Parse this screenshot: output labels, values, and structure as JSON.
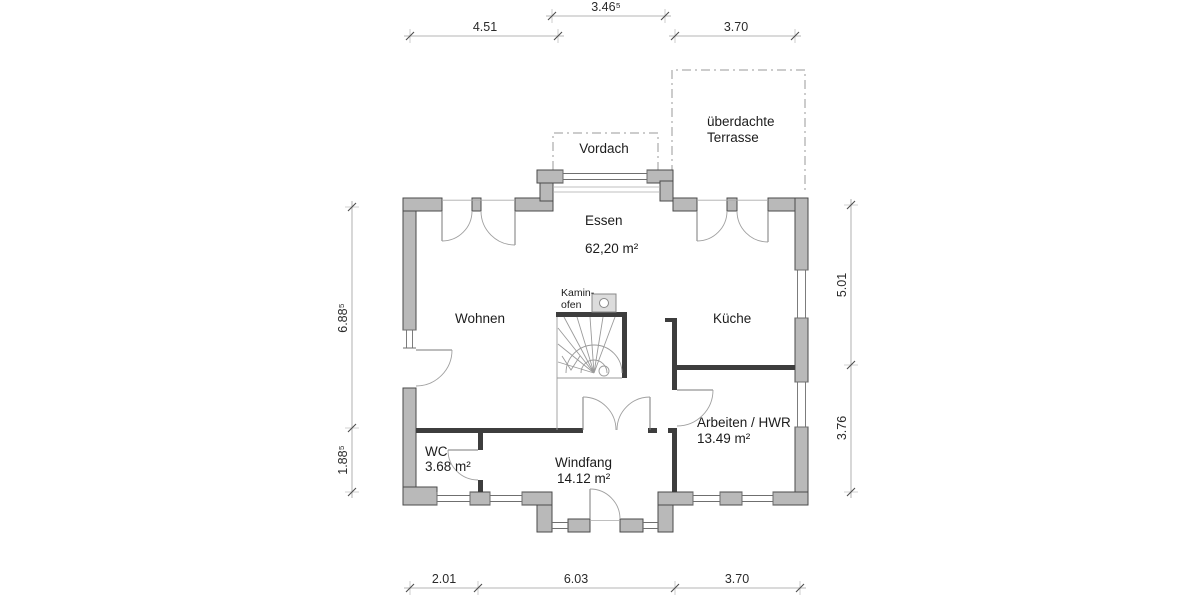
{
  "rooms": {
    "essen": {
      "name": "Essen",
      "area": "62,20 m²"
    },
    "wohnen": {
      "name": "Wohnen"
    },
    "kueche": {
      "name": "Küche"
    },
    "arbeiten": {
      "name": "Arbeiten / HWR",
      "area": "13.49 m²"
    },
    "wc": {
      "name": "WC",
      "area": "3.68 m²"
    },
    "windfang": {
      "name": "Windfang",
      "area": "14.12 m²"
    }
  },
  "annotations": {
    "vordach": "Vordach",
    "terrasse_line1": "überdachte",
    "terrasse_line2": "Terrasse",
    "kamin_line1": "Kamin-",
    "kamin_line2": "ofen"
  },
  "dimensions": {
    "top_bay": "3.46⁵",
    "top_left": "4.51",
    "top_right": "3.70",
    "left_upper": "6.88⁵",
    "left_lower": "1.88⁵",
    "right_upper": "5.01",
    "right_lower": "3.76",
    "bottom_left": "2.01",
    "bottom_mid": "6.03",
    "bottom_right": "3.70"
  },
  "colors": {
    "wall_fill": "#b9b9b9",
    "wall_stroke": "#4a4a4a",
    "interior_wall": "#3d3d3d",
    "thin_line": "#8a8a8a",
    "dashed_line": "#9a9a9a",
    "text": "#1c1c1c",
    "dim_text": "#2a2a2a"
  }
}
